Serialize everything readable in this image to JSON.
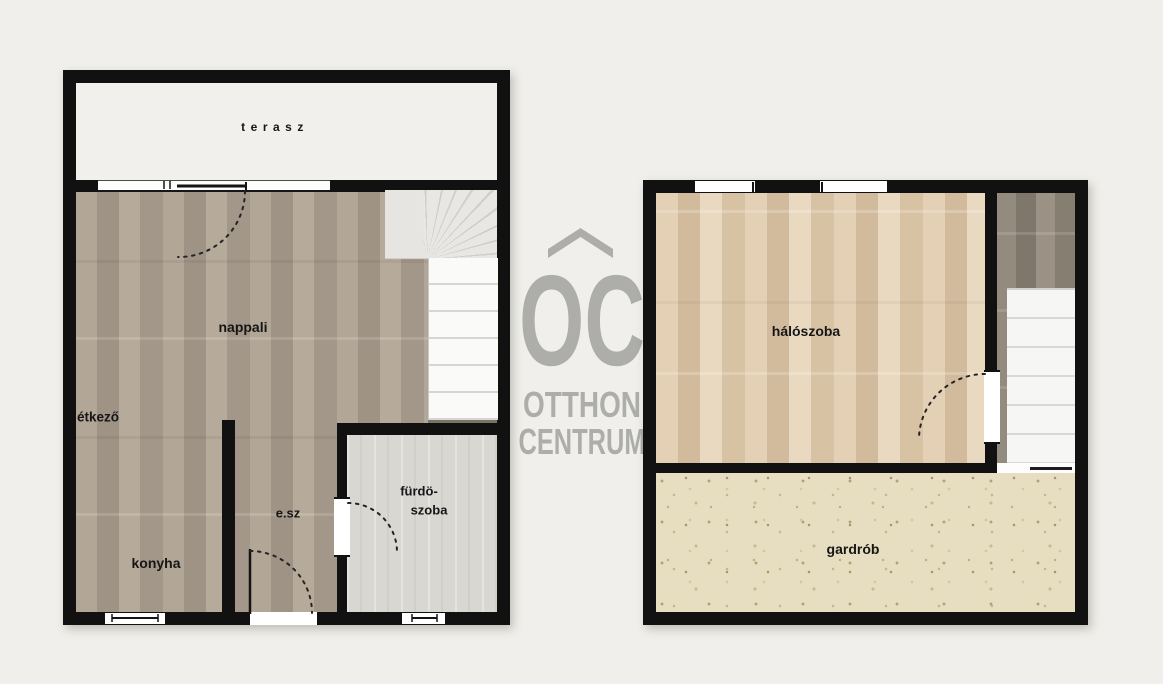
{
  "page": {
    "background_color": "#f0efeb",
    "wall_color": "#111111"
  },
  "watermark": {
    "logo_text": "OC",
    "brand_line1": "OTTHON",
    "brand_line2": "CENTRUM",
    "color": "#adaeaa"
  },
  "floor_plans": {
    "ground_floor": {
      "rooms": {
        "terasz": "terasz",
        "nappali": "nappali",
        "etkezo": "étkező",
        "konyha": "konyha",
        "elosz": "e.sz",
        "furdoszoba_line1": "fürdö-",
        "furdoszoba_line2": "szoba"
      }
    },
    "upper_floor": {
      "rooms": {
        "haloszoba": "hálószoba",
        "gardrob": "gardrób"
      }
    }
  },
  "colors": {
    "living_wood": "#a99d8e",
    "bedroom_wood": "#dcc6aa",
    "corridor_wood": "#8b8278",
    "bathroom_tile": "#d8d7d2",
    "wardrobe_carpet": "#e7ddc1",
    "terrace_floor": "#f2f0ec",
    "stairs": "#f6f6f5"
  }
}
